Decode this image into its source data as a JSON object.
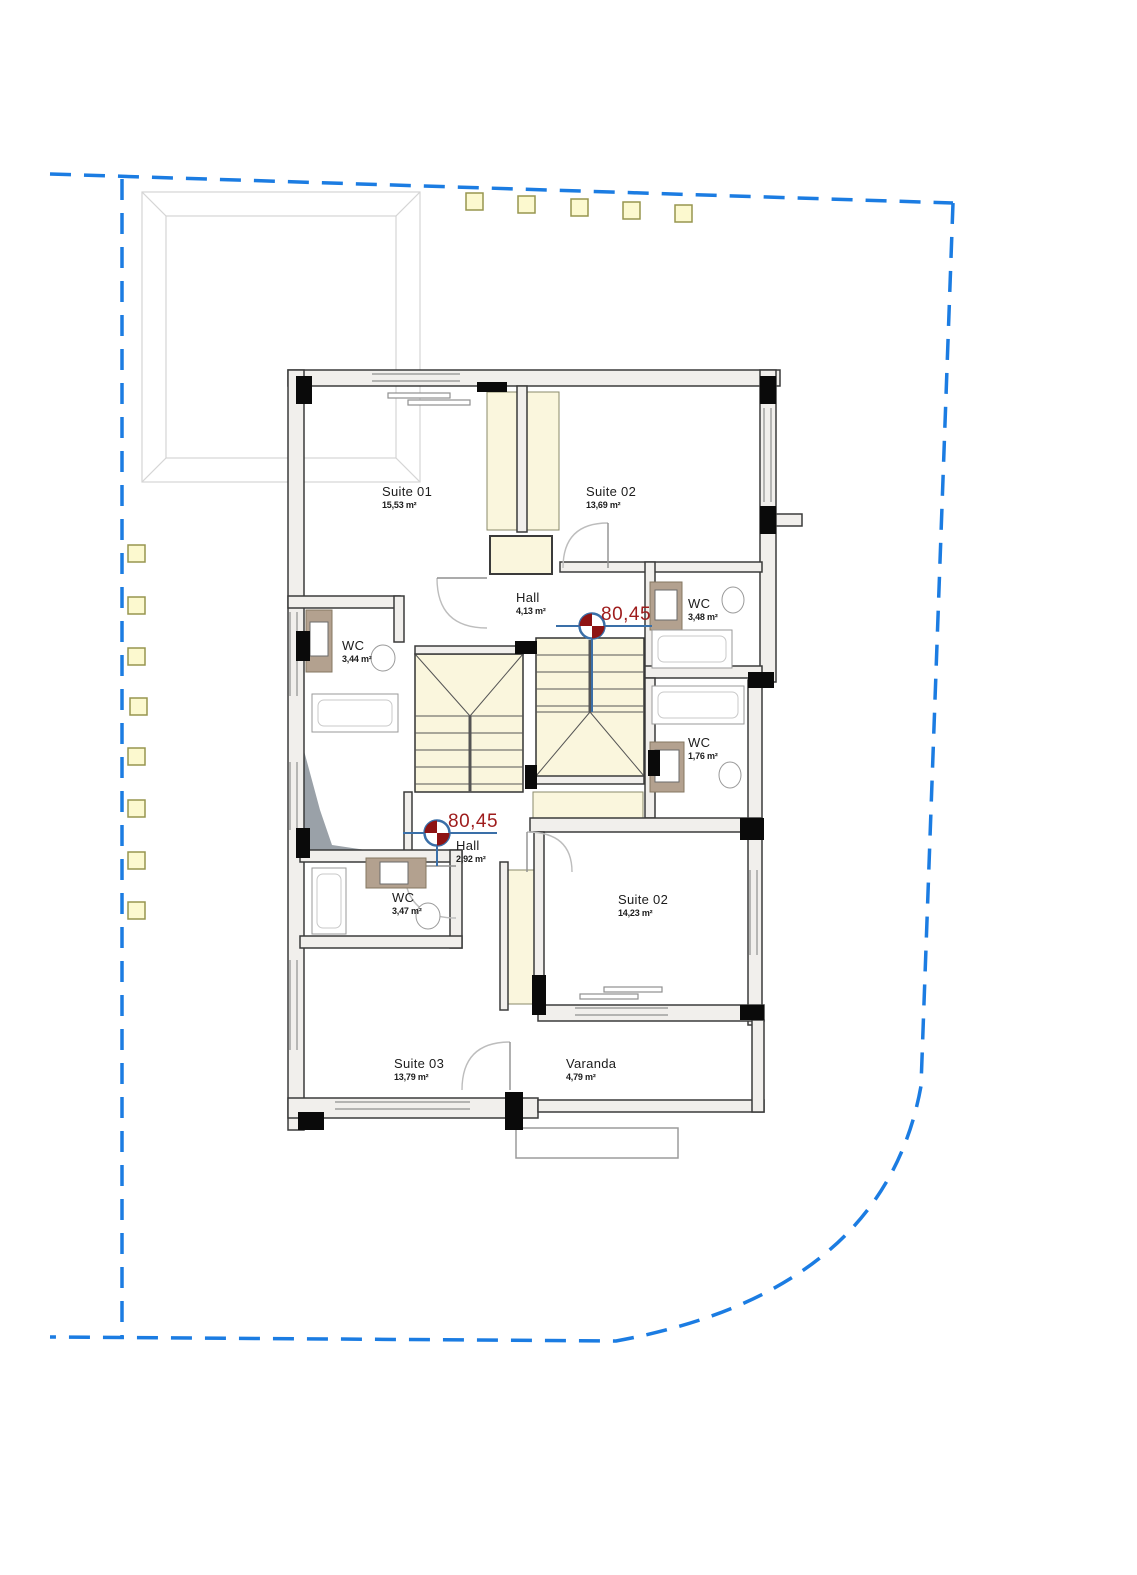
{
  "plan": {
    "title": "floor-plan",
    "rooms": [
      {
        "id": "suite-01",
        "label": "Suite 01",
        "area": "15,53 m²"
      },
      {
        "id": "suite-02-top",
        "label": "Suite 02",
        "area": "13,69 m²"
      },
      {
        "id": "hall-top",
        "label": "Hall",
        "area": "4,13 m²"
      },
      {
        "id": "wc-top-right",
        "label": "WC",
        "area": "3,48 m²"
      },
      {
        "id": "wc-left",
        "label": "WC",
        "area": "3,44 m²"
      },
      {
        "id": "wc-mid-right",
        "label": "WC",
        "area": "1,76 m²"
      },
      {
        "id": "hall-bottom",
        "label": "Hall",
        "area": "2,92 m²"
      },
      {
        "id": "wc-bottom-left",
        "label": "WC",
        "area": "3,47 m²"
      },
      {
        "id": "suite-02-bottom",
        "label": "Suite 02",
        "area": "14,23 m²"
      },
      {
        "id": "suite-03",
        "label": "Suite 03",
        "area": "13,79 m²"
      },
      {
        "id": "varanda",
        "label": "Varanda",
        "area": "4,79 m²"
      }
    ],
    "level_markers": [
      {
        "id": "level-top",
        "value": "80,45"
      },
      {
        "id": "level-bottom",
        "value": "80,45"
      }
    ],
    "colors": {
      "boundary_blue": "#1b7ce2",
      "level_red": "#9e1c1c",
      "level_line_blue": "#3a6fa8",
      "level_quadrant_red": "#8e1313",
      "skylight_fill": "#fcf9cf",
      "skylight_border": "#97954f",
      "closet_fill": "#faf6dd",
      "wall_fill": "#f1efec",
      "wall_stroke": "#3b3b3b",
      "column_black": "#0a0a0a",
      "vanity_tan": "#b3a18f",
      "roof_wedge_gray": "#9aa1a8",
      "faint_gray": "#d4d4d4"
    }
  }
}
